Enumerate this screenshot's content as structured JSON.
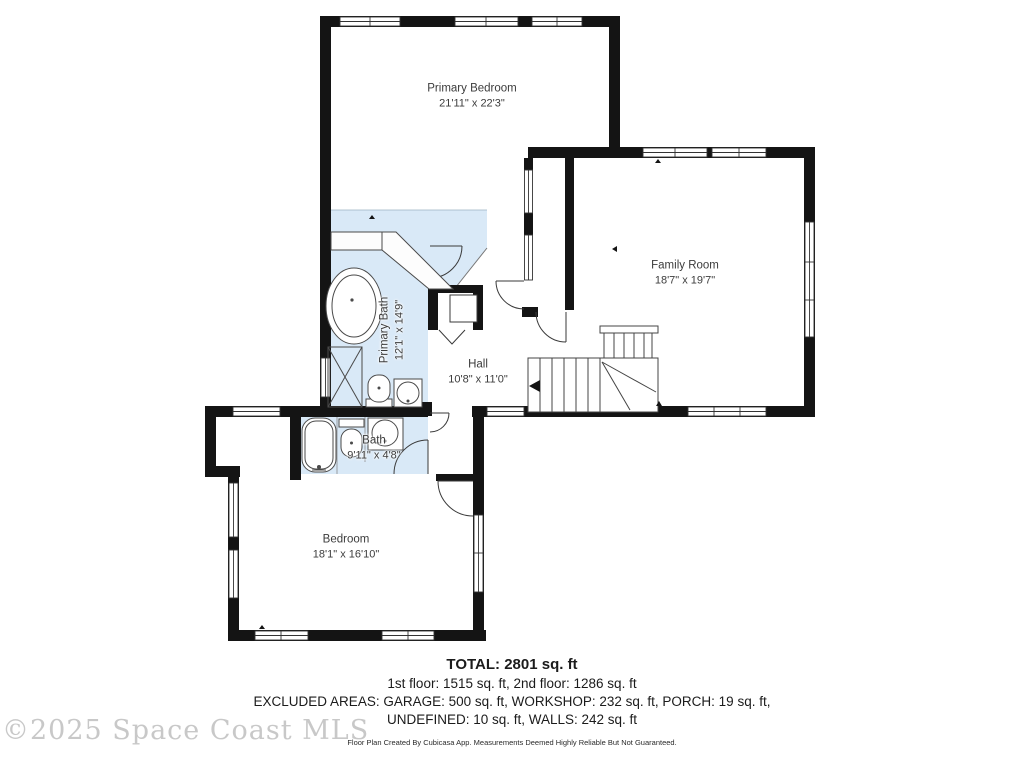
{
  "rooms": {
    "primary_bedroom": {
      "name": "Primary Bedroom",
      "dims": "21'11\" x 22'3\""
    },
    "family_room": {
      "name": "Family Room",
      "dims": "18'7\" x 19'7\""
    },
    "hall": {
      "name": "Hall",
      "dims": "10'8\" x 11'0\""
    },
    "primary_bath": {
      "name": "Primary Bath",
      "dims": "12'1\" x 14'9\""
    },
    "bath": {
      "name": "Bath",
      "dims": "9'11\" x 4'8\""
    },
    "bedroom": {
      "name": "Bedroom",
      "dims": "18'1\" x 16'10\""
    }
  },
  "summary": {
    "total": "TOTAL: 2801 sq. ft",
    "floors": "1st floor: 1515 sq. ft, 2nd floor: 1286 sq. ft",
    "excluded": "EXCLUDED AREAS: GARAGE: 500 sq. ft, WORKSHOP: 232 sq. ft, PORCH: 19 sq. ft,",
    "undefined_walls": "UNDEFINED: 10 sq. ft, WALLS: 242 sq. ft",
    "disclaimer": "Floor Plan Created By Cubicasa App. Measurements Deemed Highly Reliable But Not Guaranteed."
  },
  "watermark": "©2025 Space Coast MLS",
  "colors": {
    "bath_fill": "#d9e9f7",
    "wall": "#141414"
  }
}
